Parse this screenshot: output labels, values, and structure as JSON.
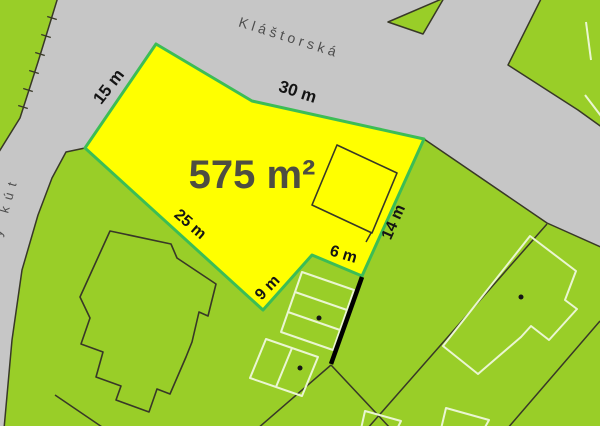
{
  "map": {
    "street_main": "Kláštorská",
    "street_side_partial": "y kút",
    "parcel": {
      "area": "575 m²",
      "dim_top": "30 m",
      "dim_left": "15 m",
      "dim_bottom": "25 m",
      "dim_right": "14 m",
      "dim_inner_left": "9 m",
      "dim_inner_bottom": "6 m"
    },
    "colors": {
      "road": "#c6c6c6",
      "parcel_green": "#99ce28",
      "highlight_fill": "#ffff00",
      "highlight_border": "#3cbd55",
      "boundary_line": "#383827",
      "light_outline": "#eaf6d2",
      "measure_line": "#000000",
      "street_text": "#4d4d4d",
      "dimension_text": "#141414",
      "area_text": "#4e4e42"
    }
  }
}
